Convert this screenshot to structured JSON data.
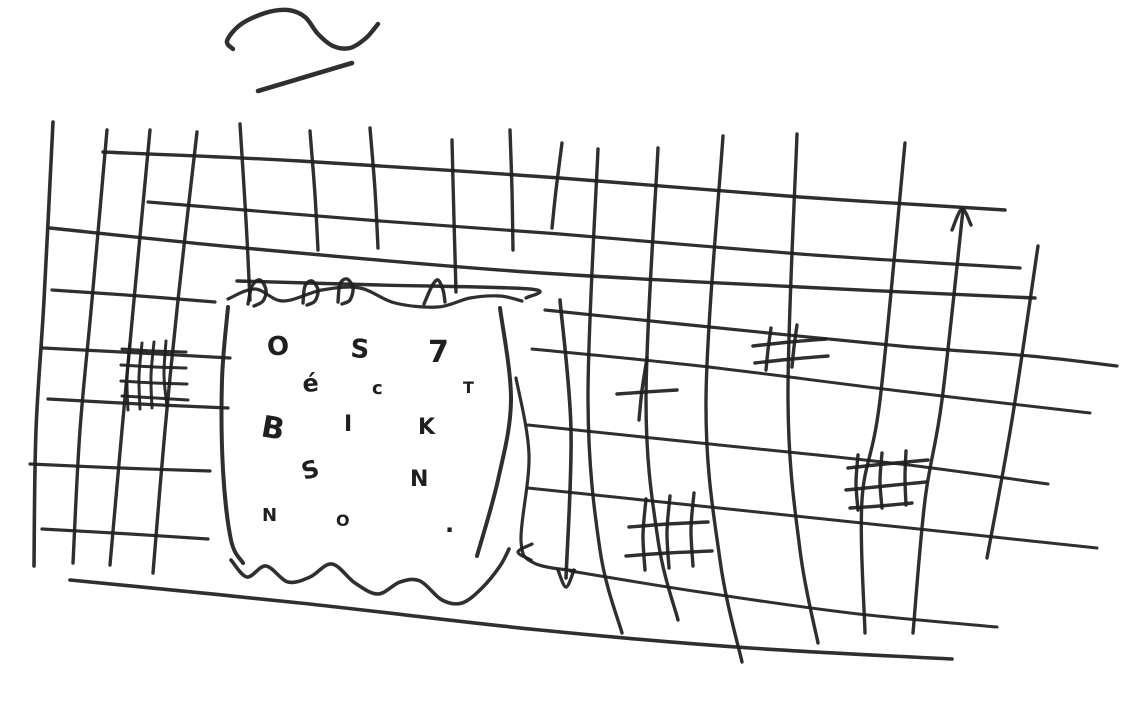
{
  "canvas": {
    "width": 1140,
    "height": 706,
    "paper_color": "#ffffff",
    "ink_color": "#1f1f1f"
  },
  "panel": {
    "letters": [
      {
        "ch": "O",
        "x": 268,
        "y": 356,
        "size": 26,
        "rot": -6
      },
      {
        "ch": "S",
        "x": 350,
        "y": 357,
        "size": 26,
        "rot": 4
      },
      {
        "ch": "7",
        "x": 428,
        "y": 362,
        "size": 30,
        "rot": 0
      },
      {
        "ch": "é",
        "x": 303,
        "y": 392,
        "size": 24,
        "rot": -4
      },
      {
        "ch": "c",
        "x": 372,
        "y": 394,
        "size": 18,
        "rot": 0
      },
      {
        "ch": "T",
        "x": 463,
        "y": 393,
        "size": 16,
        "rot": 0
      },
      {
        "ch": "B",
        "x": 260,
        "y": 436,
        "size": 30,
        "rot": 10
      },
      {
        "ch": "I",
        "x": 344,
        "y": 431,
        "size": 22,
        "rot": 0
      },
      {
        "ch": "K",
        "x": 418,
        "y": 434,
        "size": 22,
        "rot": 0
      },
      {
        "ch": "S",
        "x": 304,
        "y": 480,
        "size": 24,
        "rot": -15
      },
      {
        "ch": "N",
        "x": 410,
        "y": 486,
        "size": 22,
        "rot": 0
      },
      {
        "ch": "N",
        "x": 262,
        "y": 521,
        "size": 18,
        "rot": 0
      },
      {
        "ch": "O",
        "x": 336,
        "y": 526,
        "size": 16,
        "rot": 0
      },
      {
        "ch": ".",
        "x": 445,
        "y": 532,
        "size": 24,
        "rot": 0
      }
    ]
  },
  "marks": {
    "squiggle": "tilde-squiggle",
    "dash": "short-dash",
    "up_arrow": "arrowhead-up",
    "down_arrow": "arrowhead-down",
    "left_arrow": "arrowhead-left",
    "hatch_patch_count": 4,
    "plus_mark_count": 1
  }
}
